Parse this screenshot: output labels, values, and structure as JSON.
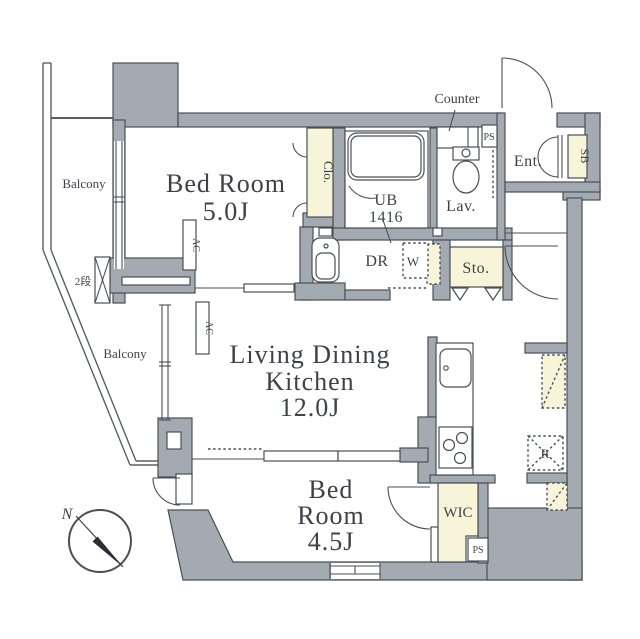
{
  "fp": {
    "colors": {
      "wall": "#a4aab2",
      "outline": "#4a4f56",
      "cream": "#f8f4da",
      "ink": "#3d4249"
    },
    "rooms": {
      "bedroom1": {
        "name": "Bed Room",
        "size": "5.0J"
      },
      "ldk": {
        "name1": "Living Dining",
        "name2": "Kitchen",
        "size": "12.0J"
      },
      "bedroom2": {
        "name1": "Bed",
        "name2": "Room",
        "size": "4.5J"
      },
      "unit_bath": {
        "name": "UB",
        "size": "1416"
      },
      "lavatory": {
        "name": "Lav."
      },
      "entrance": {
        "name": "Ent."
      },
      "storage": {
        "name": "Sto."
      },
      "closet": {
        "name": "Clo."
      },
      "shoe_box": {
        "name": "SB"
      },
      "walk_in_closet": {
        "name": "WIC"
      },
      "dressing_room": {
        "name": "DR"
      }
    },
    "labels": {
      "counter": "Counter",
      "washer": "W",
      "refrigerator": "R",
      "ac": "AC",
      "ps": "PS",
      "balcony": "Balcony",
      "steps": "2段",
      "north": "N"
    }
  }
}
